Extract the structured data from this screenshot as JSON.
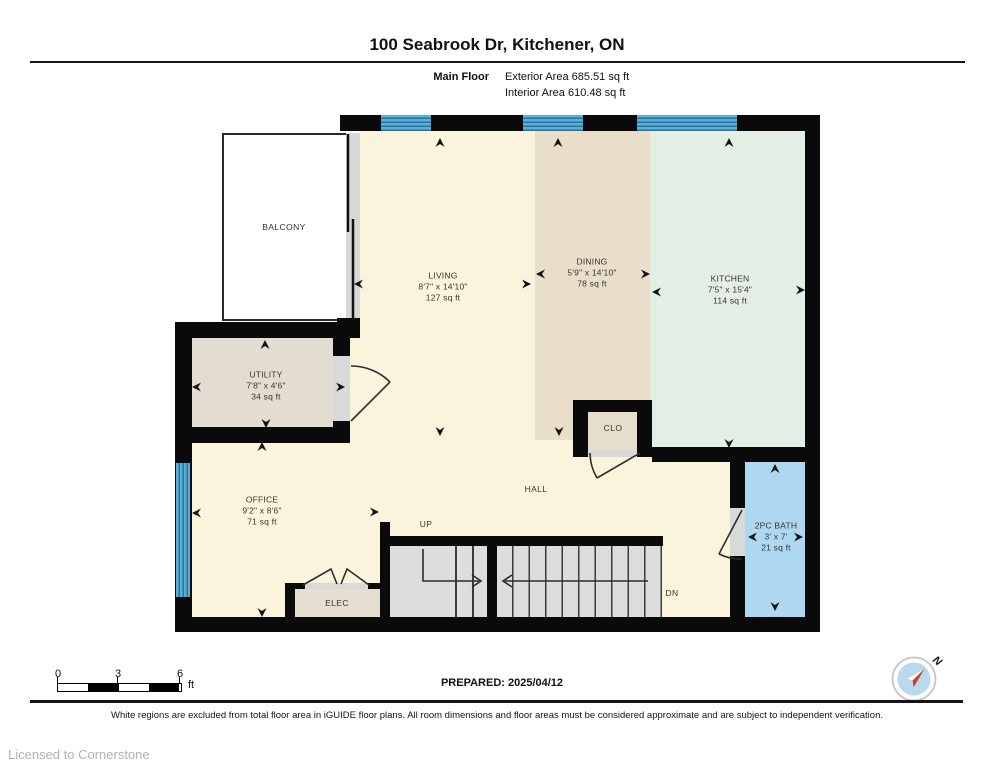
{
  "header": {
    "title": "100 Seabrook Dr, Kitchener, ON",
    "floor_label": "Main Floor",
    "exterior_area": "Exterior Area 685.51 sq ft",
    "interior_area": "Interior Area 610.48 sq ft"
  },
  "rooms": {
    "balcony": {
      "name": "BALCONY"
    },
    "living": {
      "name": "LIVING",
      "dims": "8'7\" x 14'10\"",
      "area": "127 sq ft"
    },
    "dining": {
      "name": "DINING",
      "dims": "5'9\" x 14'10\"",
      "area": "78 sq ft"
    },
    "kitchen": {
      "name": "KITCHEN",
      "dims": "7'5\" x 15'4\"",
      "area": "114 sq ft"
    },
    "utility": {
      "name": "UTILITY",
      "dims": "7'8\" x 4'6\"",
      "area": "34 sq ft"
    },
    "office": {
      "name": "OFFICE",
      "dims": "9'2\" x 8'6\"",
      "area": "71 sq ft"
    },
    "bath": {
      "name": "2PC BATH",
      "dims": "3' x 7'",
      "area": "21 sq ft"
    },
    "clo": {
      "name": "CLO"
    },
    "hall": {
      "name": "HALL"
    },
    "elec": {
      "name": "ELEC"
    }
  },
  "stairs": {
    "up_label": "UP",
    "dn_label": "DN"
  },
  "footer": {
    "scale": {
      "ticks": [
        "0",
        "3",
        "6"
      ],
      "unit": "ft"
    },
    "prepared": "PREPARED: 2025/04/12",
    "compass_label": "N",
    "disclaimer": "White regions are excluded from total floor area in iGUIDE floor plans. All room dimensions and floor areas must be considered approximate and are subject to independent verification.",
    "license": "Licensed to Cornerstone"
  },
  "colors": {
    "wall": "#0A0A0A",
    "living_cream": "#FAF4DD",
    "dining_tan": "#E8DECA",
    "kitchen_green": "#E3EEE5",
    "utility_gray": "#E3DDD1",
    "bath_blue": "#AED7F2",
    "window_blue": "#58AFDC",
    "stair_gray": "#DDDDDB",
    "compass_red": "#D6352B"
  }
}
